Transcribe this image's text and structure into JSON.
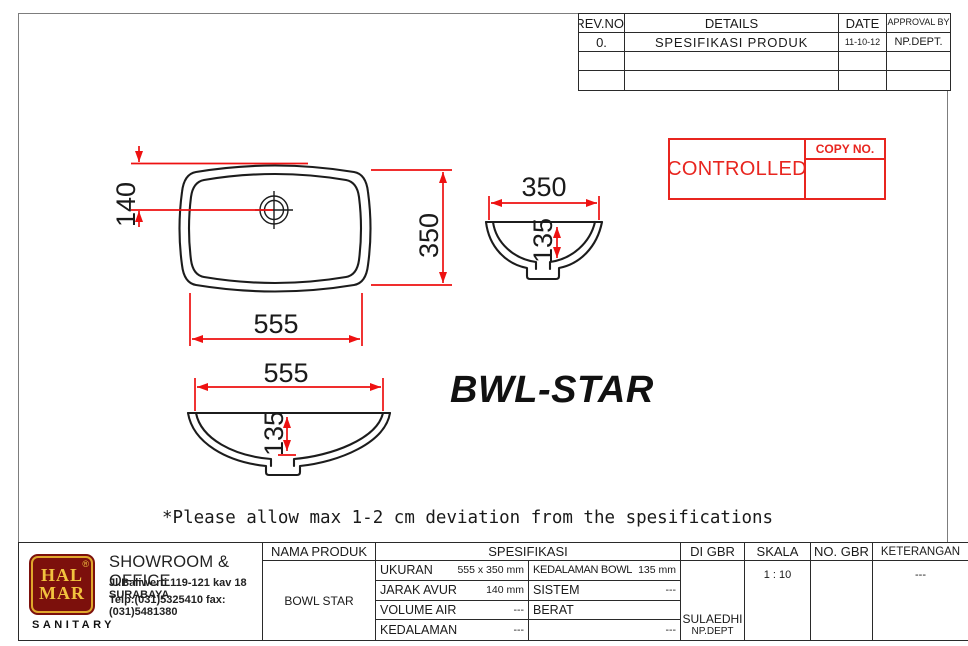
{
  "revision_table": {
    "headers": {
      "rev": "REV.NO.",
      "details": "DETAILS",
      "date": "DATE",
      "approval": "APPROVAL BY"
    },
    "rows": [
      {
        "rev": "0.",
        "details": "SPESIFIKASI PRODUK",
        "date": "11-10-12",
        "approval": "NP.DEPT."
      },
      {
        "rev": "",
        "details": "",
        "date": "",
        "approval": ""
      },
      {
        "rev": "",
        "details": "",
        "date": "",
        "approval": ""
      }
    ]
  },
  "stamp": {
    "label": "CONTROLLED",
    "copy_no_label": "COPY NO.",
    "color": "#e8251f"
  },
  "drawing": {
    "product_name": "BWL-STAR",
    "note": "*Please allow max 1-2 cm deviation from the spesifications",
    "dims": {
      "top_view": {
        "drain_offset": "140",
        "height": "350",
        "width": "555"
      },
      "side_view": {
        "width": "350",
        "depth": "135"
      },
      "front_view": {
        "width": "555",
        "depth": "135"
      }
    },
    "dimension_color": "#ee1111",
    "line_color": "#1c1c1c"
  },
  "title_block": {
    "company": {
      "logo_top": "HAL",
      "logo_bottom": "MAR",
      "registered_mark": "®",
      "sub_brand": "SANITARY",
      "office": "SHOWROOM & OFFICE",
      "address": "Jl.Baliwerti 119-121 kav 18 SURABAYA",
      "phone": "Telp:(031)5325410 fax:(031)5481380"
    },
    "nama_produk": {
      "header": "NAMA PRODUK",
      "value": "BOWL STAR"
    },
    "spesifikasi": {
      "header": "SPESIFIKASI",
      "left_rows": [
        {
          "label": "UKURAN",
          "value": "555 x 350 mm"
        },
        {
          "label": "JARAK AVUR",
          "value": "140 mm"
        },
        {
          "label": "VOLUME AIR",
          "value": "---"
        },
        {
          "label": "KEDALAMAN",
          "value": "---"
        }
      ],
      "right_rows": [
        {
          "label": "KEDALAMAN BOWL",
          "value": "135 mm"
        },
        {
          "label": "SISTEM",
          "value": "---"
        },
        {
          "label": "BERAT",
          "value": ""
        },
        {
          "label": "",
          "value": "---"
        }
      ]
    },
    "di_gbr": {
      "header": "DI GBR",
      "name": "SULAEDHI",
      "dept": "NP.DEPT"
    },
    "skala": {
      "header": "SKALA",
      "value": "1 : 10"
    },
    "no_gbr": {
      "header": "NO. GBR",
      "value": ""
    },
    "keterangan": {
      "header": "KETERANGAN",
      "value": "---"
    }
  }
}
